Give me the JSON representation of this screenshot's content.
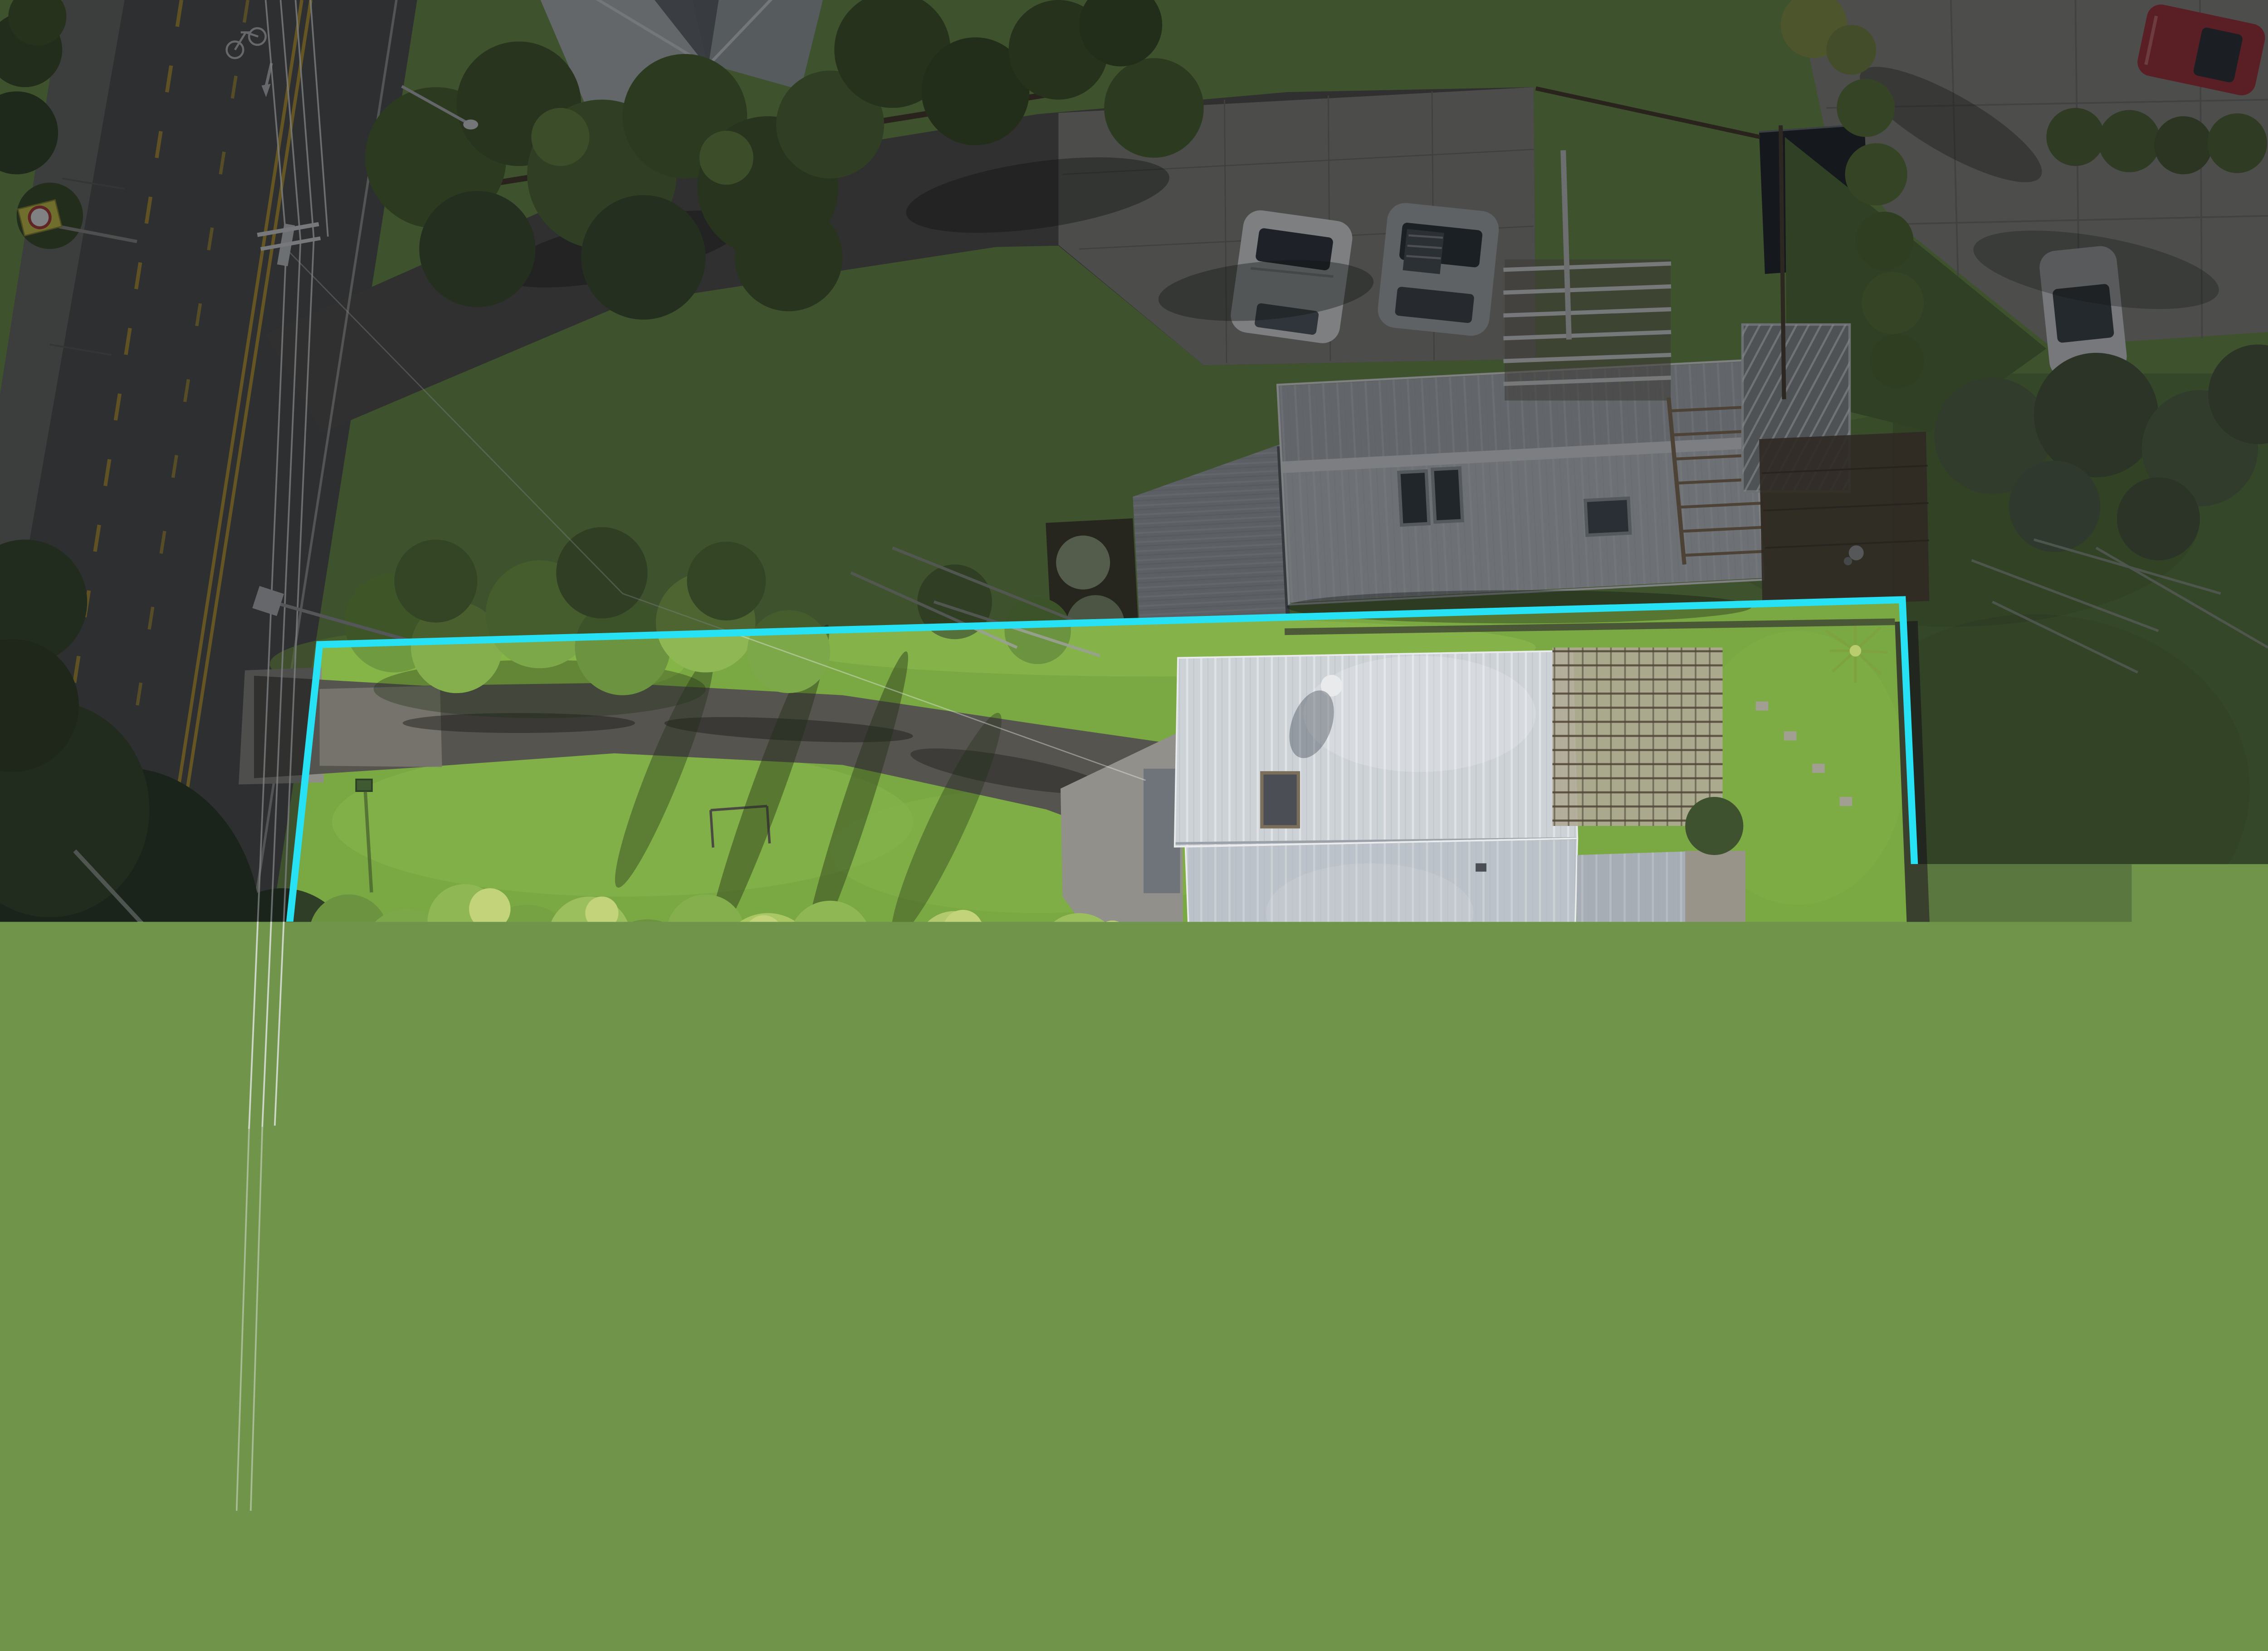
{
  "overlay": {
    "caption": "Indicative Boundary Lines",
    "boundary_color": "#27E2F5",
    "caption_color": "#FFFFFF"
  }
}
